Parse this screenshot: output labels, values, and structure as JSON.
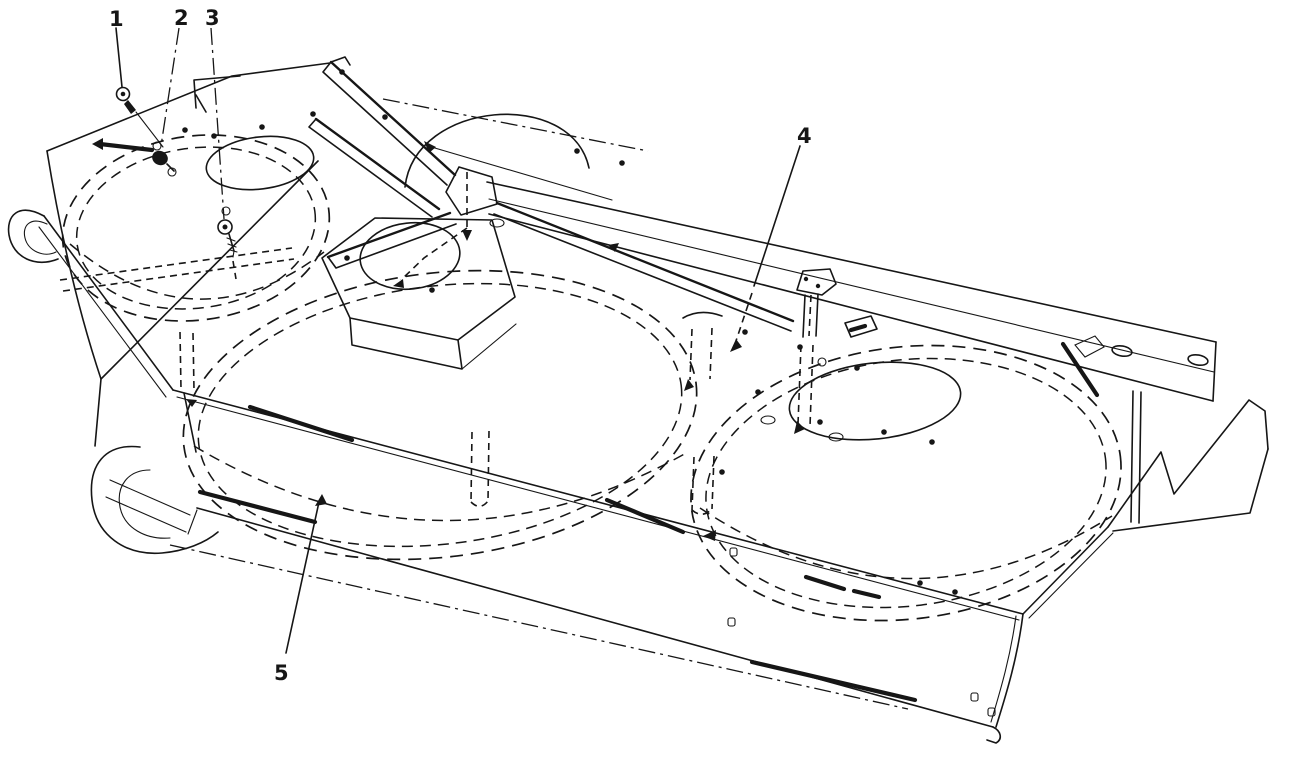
{
  "figure": {
    "type": "exploded-parts-line-diagram",
    "background_color": "#ffffff",
    "ink_color": "#161616",
    "callouts": [
      {
        "label": "1"
      },
      {
        "label": "2"
      },
      {
        "label": "3"
      },
      {
        "label": "4"
      },
      {
        "label": "5"
      }
    ]
  }
}
